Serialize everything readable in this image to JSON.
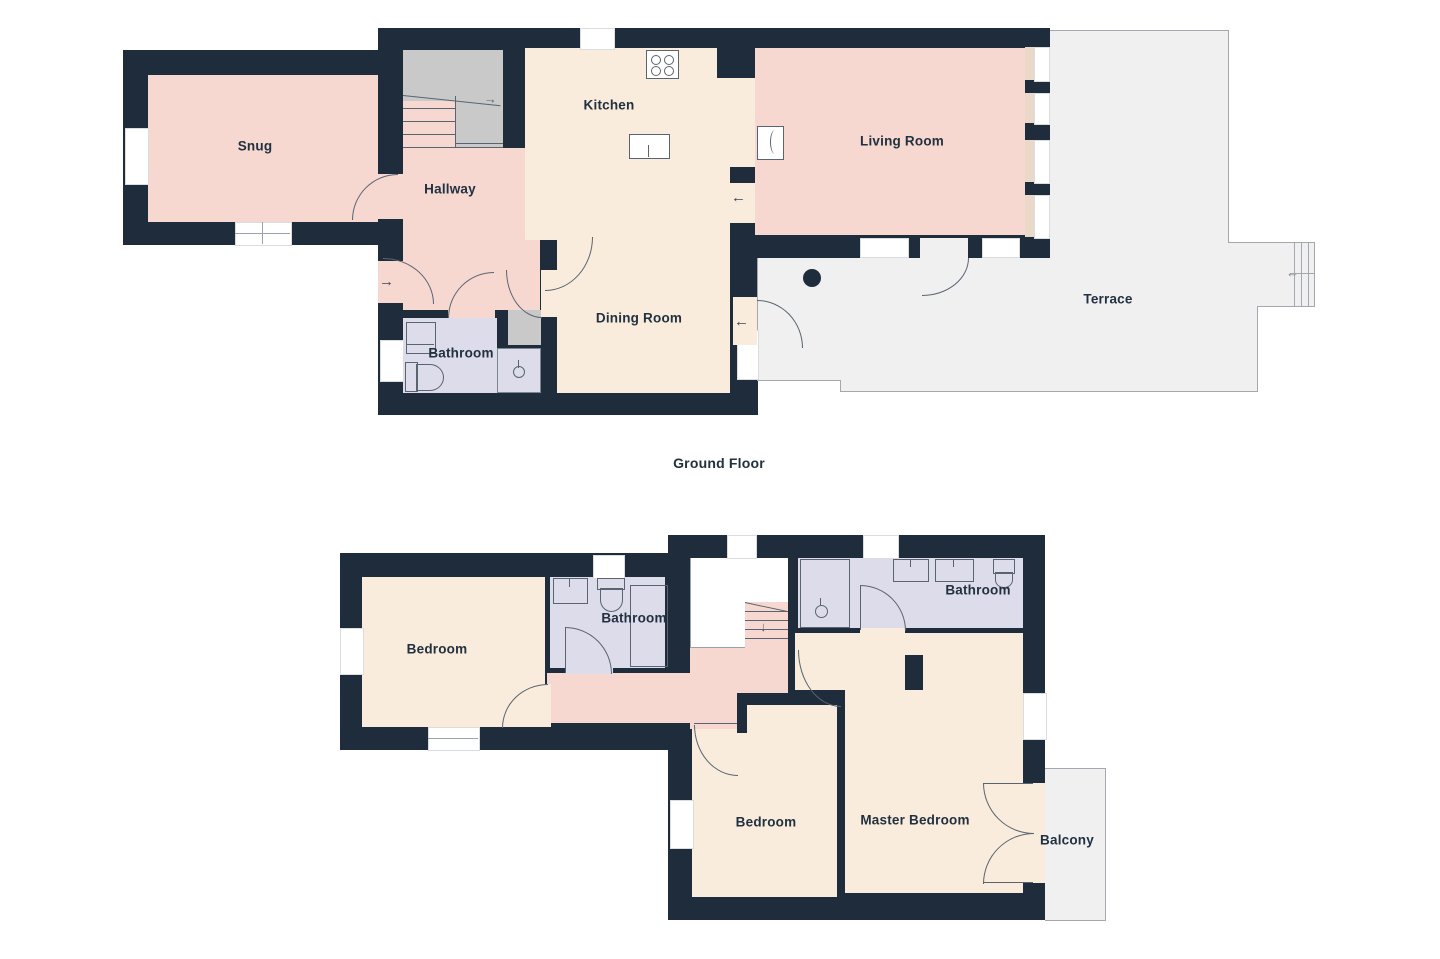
{
  "ground": {
    "caption": "Ground Floor",
    "snug": "Snug",
    "hallway": "Hallway",
    "kitchen": "Kitchen",
    "dining": "Dining Room",
    "living": "Living Room",
    "terrace": "Terrace",
    "bathroom": "Bathroom"
  },
  "first": {
    "bedroom_left": "Bedroom",
    "bathroom_left": "Bathroom",
    "bathroom_right": "Bathroom",
    "bedroom_mid": "Bedroom",
    "master": "Master Bedroom",
    "balcony": "Balcony"
  },
  "icons": {
    "right_arrow": "→",
    "left_arrow": "←",
    "down_arrow": "↓",
    "up_arrow": "→"
  },
  "colors": {
    "wall": "#1e2c3c",
    "room_pink": "#f6d8d1",
    "room_cream": "#faecdc",
    "room_lavender": "#dcdcea",
    "outdoor_gray": "#f0f0f1",
    "stairs_gray": "#c9c9c9"
  }
}
